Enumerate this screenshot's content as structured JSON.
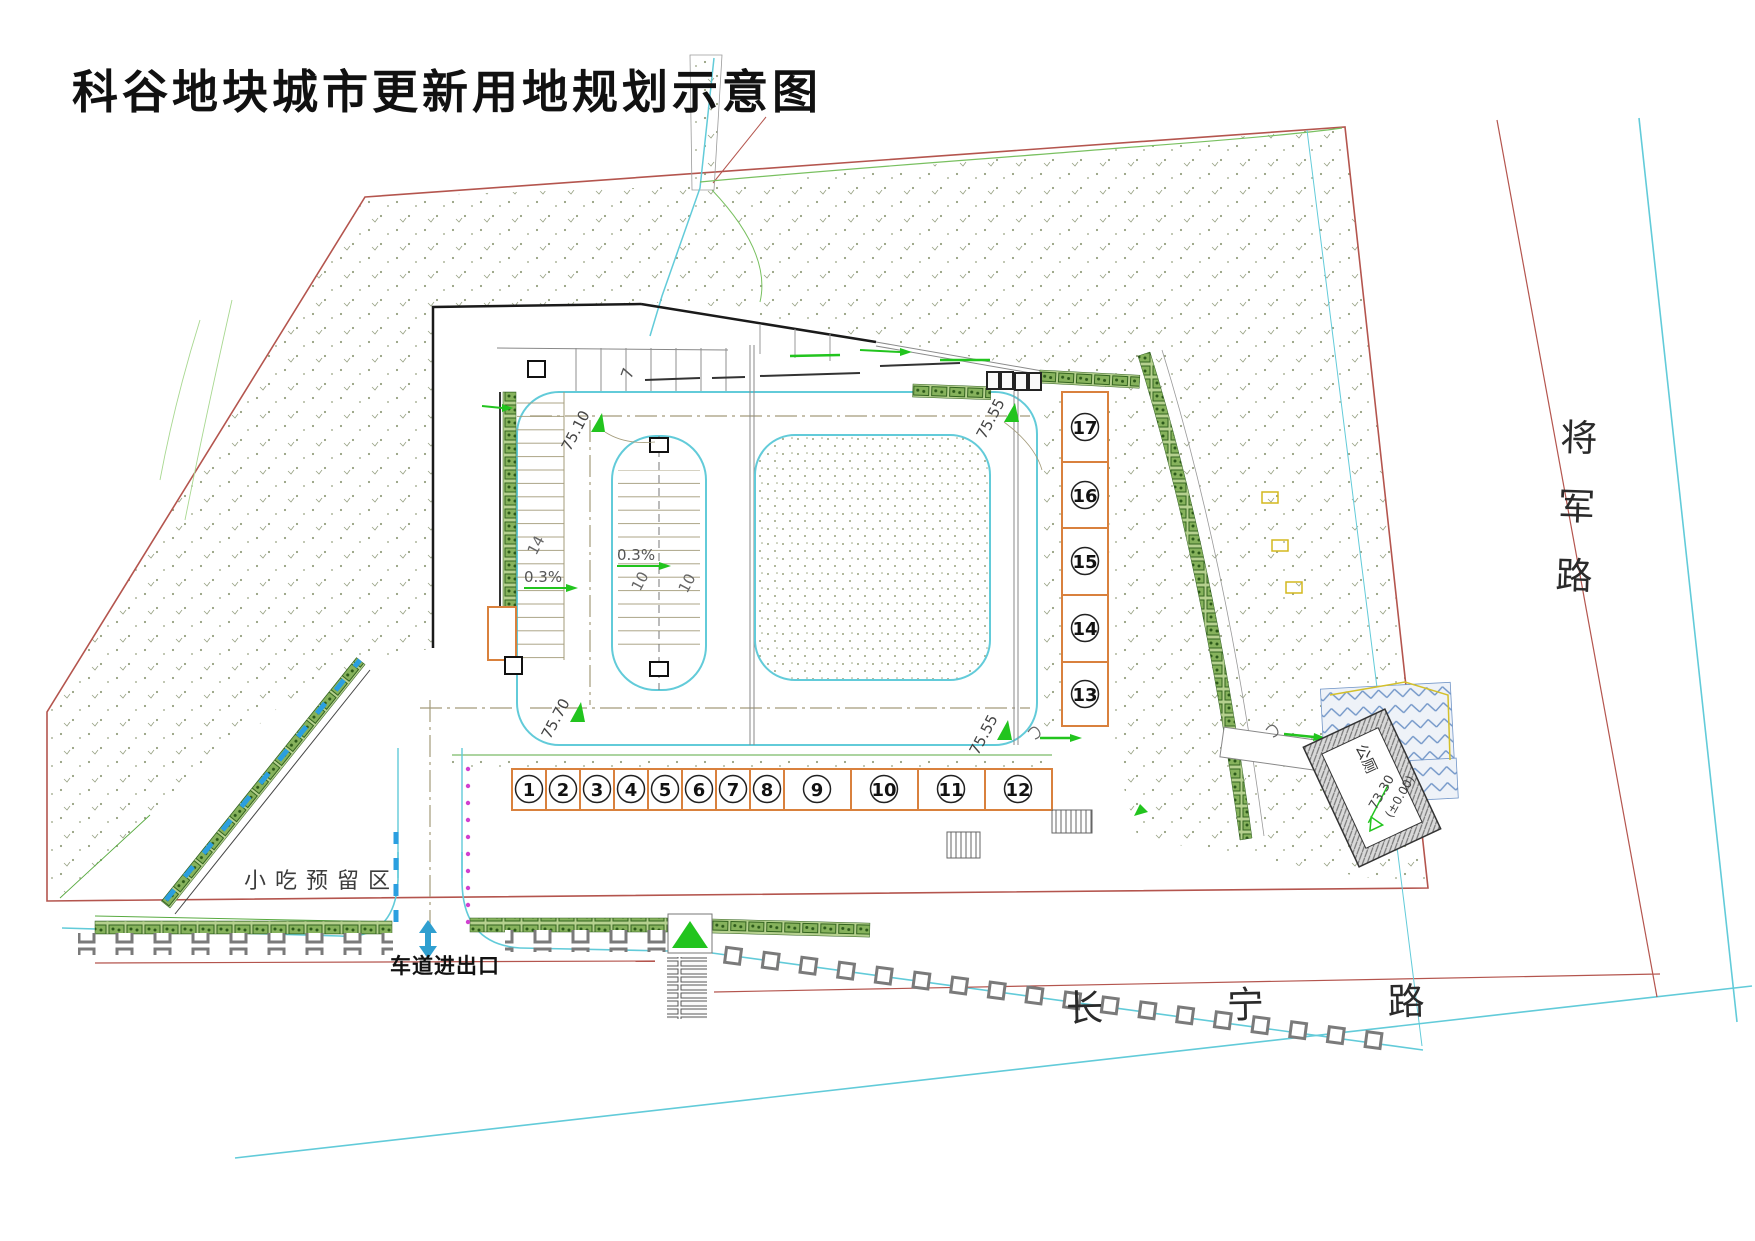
{
  "title": "科谷地块城市更新用地规划示意图",
  "roads": {
    "south": "长  宁  路",
    "east": "将军路"
  },
  "site": {
    "snack_area_label": "小吃预留区",
    "driveway_label": "车道进出口",
    "toilet_label": "公厕",
    "toilet_elevation": "73.30",
    "toilet_datum": "(±0.00)"
  },
  "elevations": {
    "tl": "75.10",
    "tr": "75.55",
    "bl": "75.70",
    "br": "75.55"
  },
  "slopes": {
    "left": "0.3%",
    "right": "0.3%"
  },
  "dims": {
    "a": "14",
    "b": "10",
    "c": "10",
    "block_mark": "7"
  },
  "units": {
    "h": [
      "1",
      "2",
      "3",
      "4",
      "5",
      "6",
      "7",
      "8",
      "9",
      "10",
      "11",
      "12"
    ],
    "v": [
      "17",
      "16",
      "15",
      "14",
      "13"
    ]
  },
  "colors": {
    "boundary_red": "#b4554e",
    "road_cyan": "#62cbd9",
    "unit_orange": "#d9813d",
    "marker_green": "#22c41e",
    "dash_blue": "#2b9fe0"
  }
}
